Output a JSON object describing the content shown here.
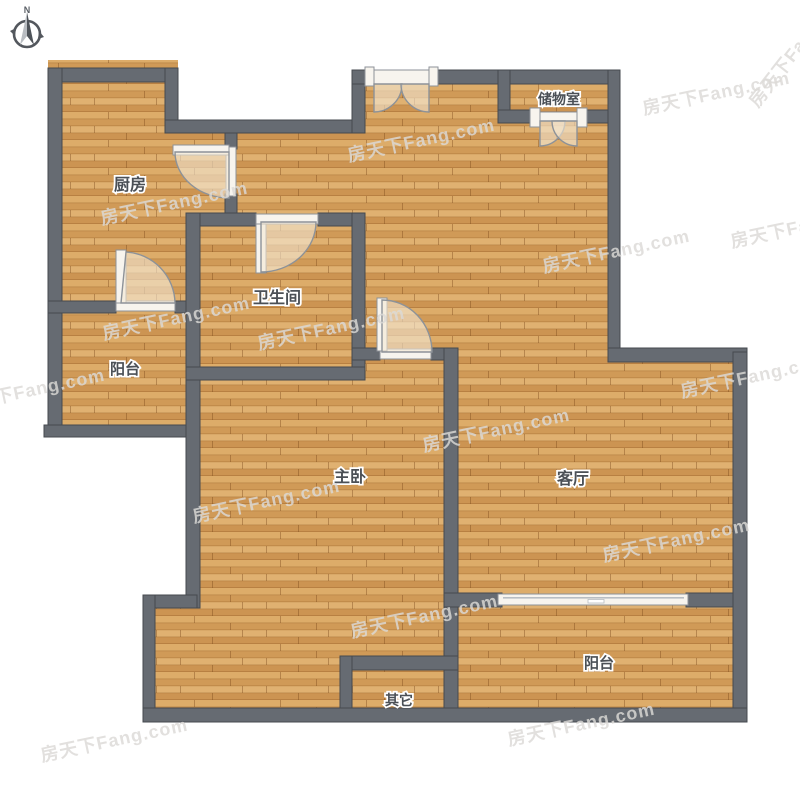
{
  "compass": {
    "north_label": "N"
  },
  "watermark": {
    "text": "房天下Fang.com"
  },
  "rooms": {
    "kitchen": {
      "label": "厨房"
    },
    "storage": {
      "label": "储物室"
    },
    "bathroom": {
      "label": "卫生间"
    },
    "balcony_left": {
      "label": "阳台"
    },
    "master_bedroom": {
      "label": "主卧"
    },
    "living_room": {
      "label": "客厅"
    },
    "other": {
      "label": "其它"
    },
    "balcony_bottom": {
      "label": "阳台"
    }
  },
  "colors": {
    "wall": "#666b72",
    "wall_outline": "#45494f",
    "floor_base": "#d4a05e",
    "door_white": "#f7f4ee",
    "arc_fill": "#f3e7d3",
    "label_text": "#4b5056"
  }
}
